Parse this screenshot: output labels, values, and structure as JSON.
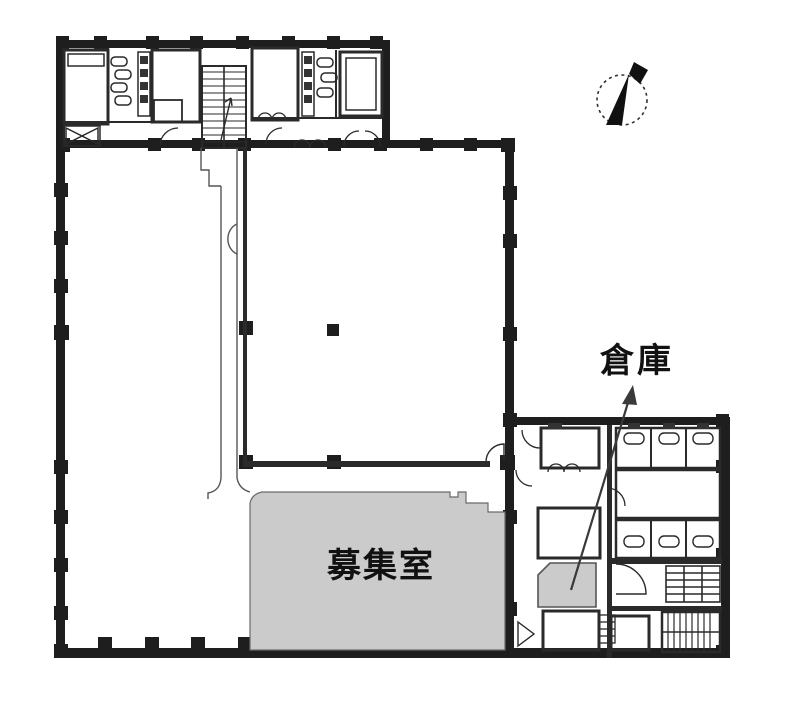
{
  "page": {
    "background": "#ffffff"
  },
  "plan": {
    "labels": {
      "available_room": "募集室",
      "storage": "倉庫"
    },
    "colors": {
      "wall": "#1e1e1e",
      "thin_line": "#555555",
      "highlight_fill": "#cbcbcb",
      "text": "#111111"
    },
    "icons": {
      "compass": "north-compass-icon"
    }
  }
}
